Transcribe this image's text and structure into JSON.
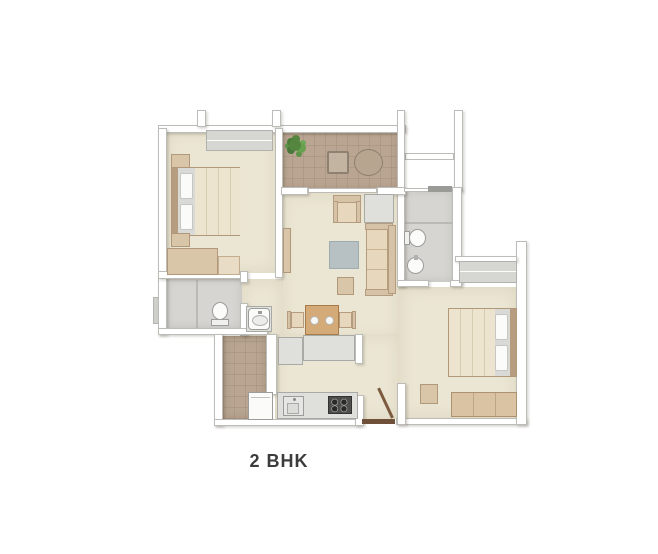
{
  "title": {
    "label": "2 BHK"
  },
  "plan": {
    "type": "apartment-floor-plan",
    "rooms": [
      {
        "id": "bedroom-1"
      },
      {
        "id": "balcony"
      },
      {
        "id": "living-room"
      },
      {
        "id": "dining-area"
      },
      {
        "id": "kitchen"
      },
      {
        "id": "utility-duct"
      },
      {
        "id": "bathroom-1"
      },
      {
        "id": "bathroom-2"
      },
      {
        "id": "bedroom-2"
      },
      {
        "id": "entrance"
      }
    ],
    "furniture": [
      "double-bed-1",
      "double-bed-2",
      "wardrobe",
      "nightstands",
      "sofa",
      "armchair",
      "side-table",
      "rug",
      "ottoman",
      "tv-unit",
      "dining-table",
      "dining-chairs",
      "kitchen-counter",
      "sink",
      "stove",
      "washing-machine",
      "wash-basin",
      "toilet-1",
      "toilet-2",
      "round-table",
      "square-table",
      "potted-plant",
      "bench",
      "stool",
      "windows",
      "entry-door"
    ]
  },
  "palette": {
    "bg": "#ffffff",
    "floor": "#ebe6d3",
    "tile": "#b9a592",
    "bath": "#d6d5d1",
    "wall": "#ffffff",
    "wall_border": "#bcbcb8",
    "wood": "#d9c6a9",
    "wood_dark": "#b2987a",
    "duvet": "#ece4cf",
    "pillow": "#fbfbf9",
    "headboard": "#b79d7f",
    "sheet": "#d9d9d5",
    "gray_obj": "#dfdfdb",
    "gray_obj_border": "#a9a9a5",
    "rug": "#b7c1c4",
    "stove": "#4e4e4a",
    "plant": "#55863f",
    "door": "#7d5b3e",
    "threshold": "#6e5138",
    "window": "#d6d6d2",
    "bath_fixture_border": "#9c9c98",
    "text": "#3c3c3c"
  }
}
